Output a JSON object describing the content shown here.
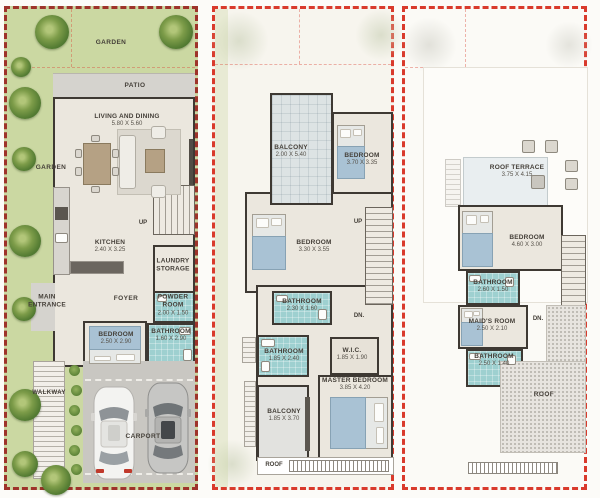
{
  "colors": {
    "boundary_red": "#d93a2c",
    "garden_green": "#cbd8a2",
    "bathroom_teal": "#9ed0d0",
    "wall_dark": "#3e3933",
    "floor_beige": "#ebe7de"
  },
  "ground_floor": {
    "garden_top": "GARDEN",
    "garden_side": "GARDEN",
    "patio": "PATIO",
    "living_dining": {
      "name": "LIVING AND DINING",
      "dims": "5.80 X 5.60"
    },
    "kitchen": {
      "name": "KITCHEN",
      "dims": "2.40 X 3.25"
    },
    "up": "UP",
    "laundry_storage": {
      "line1": "LAUNDRY",
      "line2": "STORAGE"
    },
    "main_entrance": {
      "line1": "MAIN",
      "line2": "ENTRANCE"
    },
    "foyer": "FOYER",
    "powder_room": {
      "name": "POWDER ROOM",
      "dims": "2.00 X 1.50"
    },
    "bathroom": {
      "name": "BATHROOM",
      "dims": "1.60 X 2.90"
    },
    "bedroom": {
      "name": "BEDROOM",
      "dims": "2.50 X 2.90"
    },
    "walkway": "WALKWAY",
    "carport": "CARPORT"
  },
  "first_floor": {
    "balcony_front": {
      "name": "BALCONY",
      "dims": "2.00 X 5.40"
    },
    "bedroom_front": {
      "name": "BEDROOM",
      "dims": "3.70 X 3.35"
    },
    "bedroom_mid": {
      "name": "BEDROOM",
      "dims": "3.30 X 3.55"
    },
    "up": "UP",
    "dn": "DN.",
    "bathroom_hall": {
      "name": "BATHROOM",
      "dims": "2.30 X 1.60"
    },
    "bathroom_master": {
      "name": "BATHROOM",
      "dims": "1.85 X 2.40"
    },
    "wic": {
      "name": "W.I.C.",
      "dims": "1.85 X 1.90"
    },
    "master_bedroom": {
      "name": "MASTER BEDROOM",
      "dims": "3.85 X 4.20"
    },
    "balcony_rear": {
      "name": "BALCONY",
      "dims": "1.85 X 3.70"
    },
    "roof": "ROOF"
  },
  "roof_floor": {
    "roof_terrace": {
      "name": "ROOF TERRACE",
      "dims": "3.75 X 4.15"
    },
    "bedroom": {
      "name": "BEDROOM",
      "dims": "4.60 X 3.00"
    },
    "bathroom_upper": {
      "name": "BATHROOM",
      "dims": "2.60 X 1.50"
    },
    "dn": "DN.",
    "maids_room": {
      "name": "MAID'S ROOM",
      "dims": "2.50 X 2.10"
    },
    "bathroom_lower": {
      "name": "BATHROOM",
      "dims": "2.50 X 1.40"
    },
    "roof": "ROOF"
  }
}
